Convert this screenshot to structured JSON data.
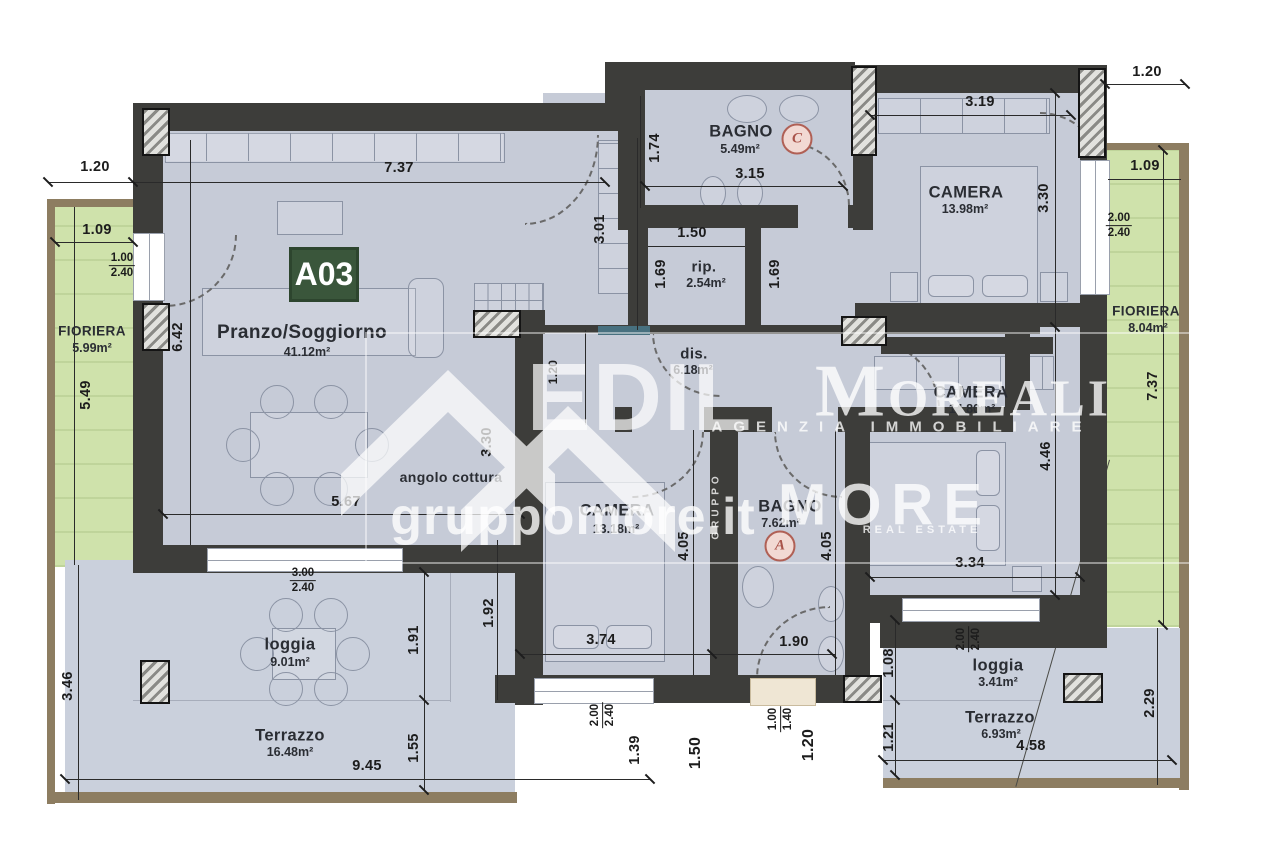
{
  "badges": {
    "unit": "A03",
    "door_a": "A",
    "door_c": "C"
  },
  "rooms": {
    "pranzo": {
      "name": "Pranzo/Soggiorno",
      "area": "41.12m²"
    },
    "angolo": {
      "name": "angolo cottura"
    },
    "bagno1": {
      "name": "BAGNO",
      "area": "5.49m²"
    },
    "rip": {
      "name": "rip.",
      "area": "2.54m²"
    },
    "dis": {
      "name": "dis.",
      "area": "6.18m²"
    },
    "camera1": {
      "name": "CAMERA",
      "area": "13.98m²"
    },
    "camera2": {
      "name": "CAMERA",
      "area": "14.80m²"
    },
    "camera3": {
      "name": "CAMERA",
      "area": "13.18m²"
    },
    "bagno2": {
      "name": "BAGNO",
      "area": "7.62m²"
    },
    "loggia1": {
      "name": "loggia",
      "area": "9.01m²"
    },
    "terrazzo1": {
      "name": "Terrazzo",
      "area": "16.48m²"
    },
    "loggia2": {
      "name": "loggia",
      "area": "3.41m²"
    },
    "terrazzo2": {
      "name": "Terrazzo",
      "area": "6.93m²"
    },
    "fioriera1": {
      "name": "FIORIERA",
      "area": "5.99m²"
    },
    "fioriera2": {
      "name": "FIORIERA",
      "area": "8.04m²"
    }
  },
  "dims": [
    "1.20",
    "7.37",
    "1.09",
    "1.00",
    "2.40",
    "5.49",
    "6.42",
    "5.67",
    "3.30",
    "3.00",
    "2.40",
    "1.91",
    "1.92",
    "3.46",
    "9.45",
    "1.55",
    "1.74",
    "3.01",
    "1.20",
    "3.15",
    "1.50",
    "1.69",
    "1.69",
    "3.19",
    "1.20",
    "3.30",
    "1.09",
    "2.00",
    "2.40",
    "4.46",
    "7.37",
    "3.34",
    "4.05",
    "4.05",
    "3.74",
    "1.90",
    "2.00",
    "2.40",
    "1.39",
    "1.50",
    "1.00",
    "1.40",
    "1.20",
    "1.08",
    "1.21",
    "2.00",
    "2.40",
    "4.58",
    "2.29"
  ],
  "watermark": {
    "edil": "EDIL",
    "moreali": "Moreali",
    "agenzia": "AGENZIA IMMOBILIARE",
    "site": "gruppomore.it",
    "more": "MORE",
    "gruppo": "GRUPPO",
    "real_estate": "REAL ESTATE"
  }
}
